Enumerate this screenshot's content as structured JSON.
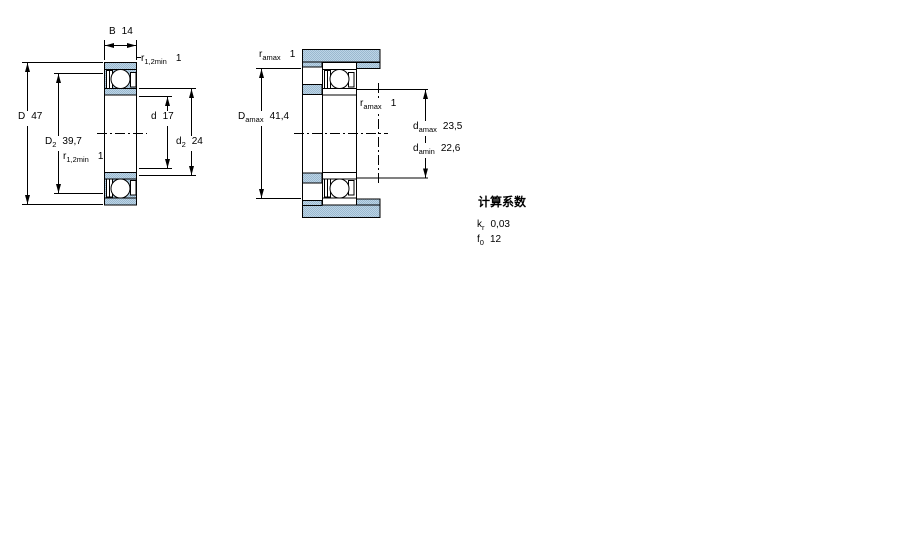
{
  "colors": {
    "steel_light": "#bcd4e6",
    "steel_dark": "#9bb9cf",
    "line": "#000000"
  },
  "left_view": {
    "description": "bearing cross section with boundary dimensions",
    "dims": {
      "B": {
        "label": "B",
        "sub": "",
        "value": "14"
      },
      "r_top": {
        "label": "r",
        "sub": "1,2min",
        "value": "1"
      },
      "D": {
        "label": "D",
        "sub": "",
        "value": "47"
      },
      "D2": {
        "label": "D",
        "sub": "2",
        "value": "39,7"
      },
      "r_mid": {
        "label": "r",
        "sub": "1,2min",
        "value": "1"
      },
      "d": {
        "label": "d",
        "sub": "",
        "value": "17"
      },
      "d2": {
        "label": "d",
        "sub": "2",
        "value": "24"
      }
    }
  },
  "right_view": {
    "description": "mounted bearing with abutment dimensions",
    "dims": {
      "r_a_top": {
        "label": "r",
        "sub": "amax",
        "value": "1"
      },
      "D_a": {
        "label": "D",
        "sub": "amax",
        "value": "41,4"
      },
      "r_a_mid": {
        "label": "r",
        "sub": "amax",
        "value": "1"
      },
      "d_a_max": {
        "label": "d",
        "sub": "amax",
        "value": "23,5"
      },
      "d_a_min": {
        "label": "d",
        "sub": "amin",
        "value": "22,6"
      }
    }
  },
  "calculation_factors": {
    "title": "计算系数",
    "items": [
      {
        "label": "k",
        "sub": "r",
        "value": "0,03"
      },
      {
        "label": "f",
        "sub": "0",
        "value": "12"
      }
    ]
  }
}
